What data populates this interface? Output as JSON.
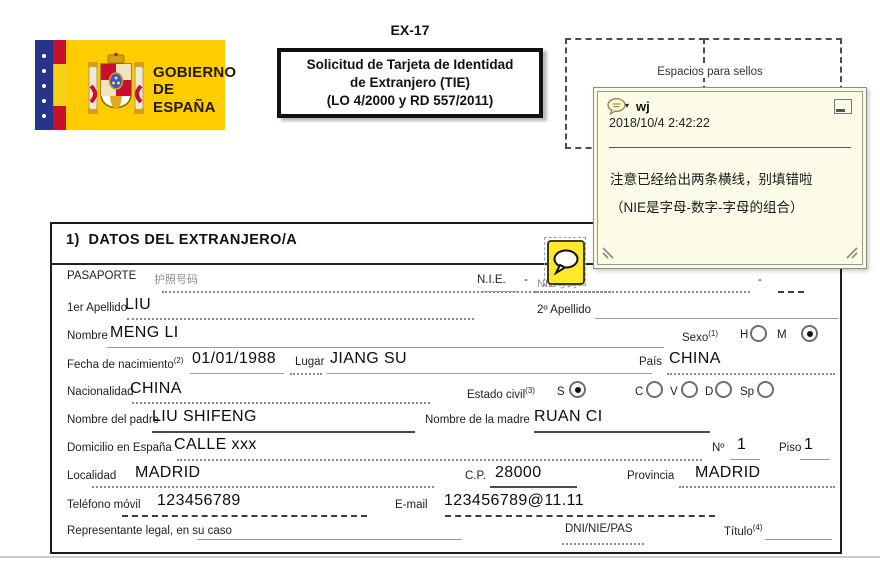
{
  "header": {
    "form_code": "EX-17",
    "logo": {
      "line1": "GOBIERNO",
      "line2": "DE ESPAÑA"
    },
    "title_box": {
      "line1": "Solicitud de Tarjeta de Identidad",
      "line2": "de Extranjero (TIE)",
      "line3": "(LO 4/2000 y RD 557/2011)"
    },
    "stamp_label": "Espacios para sellos"
  },
  "note": {
    "author": "wj",
    "caret": "▾",
    "timestamp": "2018/10/4 2:42:22",
    "line1": "注意已经给出两条横线，别填错啦",
    "line2": "（NIE是字母-数字-字母的组合）"
  },
  "form": {
    "section_title": "1)  DATOS DEL EXTRANJERO/A",
    "dash": "-",
    "pasaporte": {
      "label": "PASAPORTE",
      "hint": "护照号码",
      "value": ""
    },
    "nie": {
      "label": "N.I.E.",
      "hint": "NIE号码",
      "value": ""
    },
    "apellido1": {
      "label": "1er Apellido",
      "value": "LIU"
    },
    "apellido2": {
      "label": "2º Apellido",
      "value": ""
    },
    "nombre": {
      "label": "Nombre",
      "value": "MENG LI"
    },
    "sexo": {
      "label": "Sexo",
      "sup": "(1)",
      "options": [
        {
          "label": "H",
          "checked": false
        },
        {
          "label": "M",
          "checked": true
        }
      ]
    },
    "fecha": {
      "label": "Fecha de nacimiento",
      "sup": "(2)",
      "value": "01/01/1988"
    },
    "lugar": {
      "label": "Lugar",
      "value": "JIANG SU"
    },
    "pais": {
      "label": "País",
      "value": "CHINA"
    },
    "nacionalidad": {
      "label": "Nacionalidad",
      "value": "CHINA"
    },
    "estado_civil": {
      "label": "Estado civil",
      "sup": "(3)",
      "options": [
        {
          "label": "S",
          "checked": true
        },
        {
          "label": "C",
          "checked": false
        },
        {
          "label": "V",
          "checked": false
        },
        {
          "label": "D",
          "checked": false
        },
        {
          "label": "Sp",
          "checked": false
        }
      ]
    },
    "padre": {
      "label": "Nombre del padre",
      "value": "LIU SHIFENG"
    },
    "madre": {
      "label": "Nombre de la madre",
      "value": "RUAN CI"
    },
    "domicilio": {
      "label": "Domicilio en España",
      "value": "CALLE xxx"
    },
    "numero": {
      "label": "Nº",
      "value": "1"
    },
    "piso": {
      "label": "Piso",
      "value": "1"
    },
    "localidad": {
      "label": "Localidad",
      "value": "MADRID"
    },
    "cp": {
      "label": "C.P.",
      "value": "28000"
    },
    "provincia": {
      "label": "Provincia",
      "value": "MADRID"
    },
    "telefono": {
      "label": "Teléfono móvil",
      "value": "123456789"
    },
    "email": {
      "label": "E-mail",
      "value": "123456789@11.11"
    },
    "representante": {
      "label": "Representante legal, en su caso",
      "value": ""
    },
    "dni": {
      "label": "DNI/NIE/PAS",
      "value": ""
    },
    "titulo": {
      "label": "Título",
      "sup": "(4)",
      "value": ""
    }
  },
  "colors": {
    "logo_yellow": "#ffcc00",
    "logo_blue": "#27348b",
    "flag_red": "#c8102e",
    "note_bg": "#fbfbe8",
    "comment_icon_yellow": "#ffe92a",
    "line_gray": "#8d8d8d"
  }
}
